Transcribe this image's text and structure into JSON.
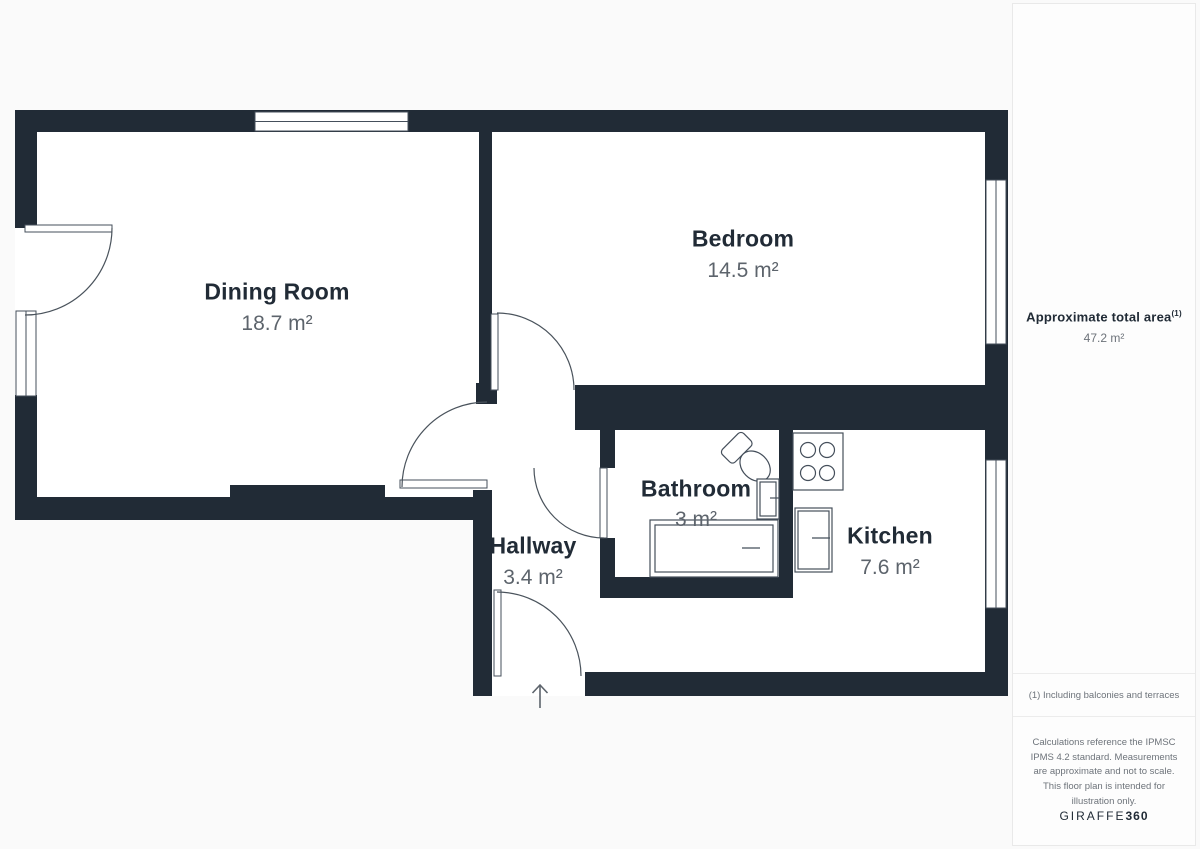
{
  "plan": {
    "rooms": [
      {
        "name": "Dining Room",
        "area": "18.7 m²"
      },
      {
        "name": "Bedroom",
        "area": "14.5 m²"
      },
      {
        "name": "Bathroom",
        "area": "3 m²"
      },
      {
        "name": "Kitchen",
        "area": "7.6 m²"
      },
      {
        "name": "Hallway",
        "area": "3.4 m²"
      }
    ]
  },
  "sidebar": {
    "total_area_label": "Approximate total area",
    "total_area_sup": "(1)",
    "total_area_value": "47.2 m²",
    "footnote": "(1) Including balconies and terraces",
    "disclaimer": "Calculations reference the IPMSC IPMS 4.2 standard. Measurements are approximate and not to scale. This floor plan is intended for illustration only.",
    "brand_name": "GIRAFFE",
    "brand_suffix": "360"
  },
  "colors": {
    "wall": "#212b36",
    "line": "#454f5b",
    "label": "#212b36",
    "value": "#5d646c",
    "muted": "#6d737a"
  }
}
